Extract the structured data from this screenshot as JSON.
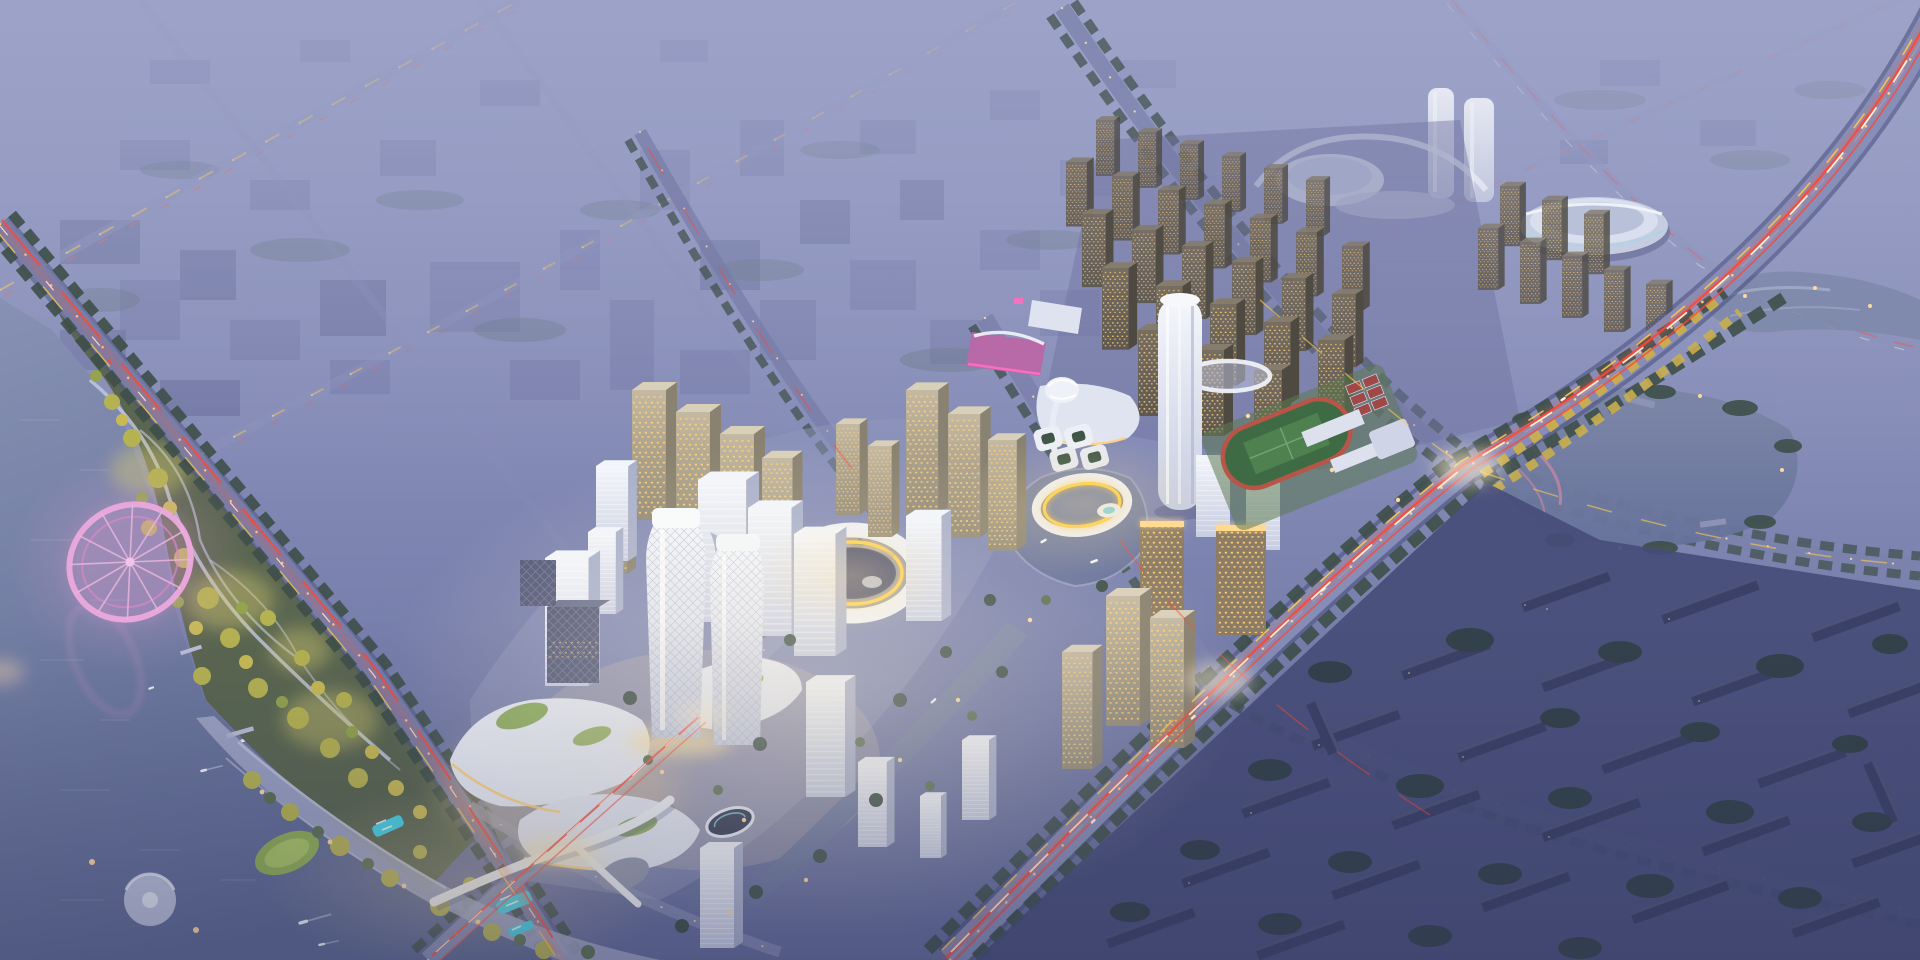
{
  "scene": {
    "title": "Aerial dusk rendering of a riverside city masterplan: illuminated CBD towers and gold ring buildings at center, waterfront park with pink ferris wheel at left, residential tower grids and light-trail avenues fading into violet haze",
    "regions": [
      "sky-haze",
      "distant-city",
      "far-landmarks",
      "residential-grid",
      "waterfront-park",
      "ferris-wheel",
      "lake",
      "central-business-district",
      "gold-ring-building",
      "gold-ring-pond",
      "sports-campus",
      "dark-residential-district",
      "wetland-pond",
      "light-trail-avenues"
    ],
    "palette": {
      "sky_top": "#9aa0c6",
      "sky_mid": "#7e85b1",
      "sky_bottom": "#636b99",
      "haze_veil": "#9ea4c9",
      "haze_block": "#6f75a2",
      "haze_block_light": "#7b81ac",
      "far_white": "#dfe4f1",
      "water_top": "#8691b3",
      "water_bottom": "#5d6892",
      "pond_top": "#7b86a6",
      "pond_bottom": "#67729b",
      "road": "#8a90ba",
      "road_minor": "#7b81ab",
      "road_casing": "#4d5380",
      "trail_red": "#ff4636",
      "trail_yellow": "#ffc84a",
      "trail_white": "#fff7e2",
      "streetlight": "#ffd9a0",
      "tree_dark": "#3e4f49",
      "tree_mid": "#5b7052",
      "tree_bright": "#b5b252",
      "tree_gold": "#c9ae4e",
      "tree_glow": "#d9cf6e",
      "park_base": "#5a6650",
      "lawn": "#8fae55",
      "pool_teal": "#3fd2ea",
      "white_hi": "#f4f6fb",
      "white_lo": "#c7cde2",
      "white_side": "#aab1cc",
      "white_top": "#f2f5fb",
      "beige_hi": "#c4b9a2",
      "beige_lo": "#948b77",
      "beige_side": "#8a8270",
      "beige_top": "#d9d0ba",
      "res_hi": "#776e62",
      "res_lo": "#5e5850",
      "res_side": "#4e4a42",
      "res_top": "#857c6e",
      "window_warm": "#ffd27a",
      "dark_face": "#565a78",
      "dark_block": "#3a4066",
      "dark_block_top": "#4d5378",
      "district_plate": "#474d78",
      "gold": "#ffcf46",
      "glow_warm": "#ffe3a0",
      "glow_center": "#fff4da",
      "pink_mall": "#b86aa8",
      "pink_neon": "#ff6ec0",
      "ferris_ring": "#edaade",
      "ferris_spoke": "#e9bade",
      "path_pink": "#c98aa0",
      "field_green": "#3f6b44",
      "pitch_green": "#4f8050",
      "track_red": "#b65548",
      "court_red": "#a04848",
      "plate_cbd": "#9298be",
      "plaza": "#c3c8de",
      "canal_edge": "#aab0cc",
      "vignette": "#2e3458"
    }
  }
}
